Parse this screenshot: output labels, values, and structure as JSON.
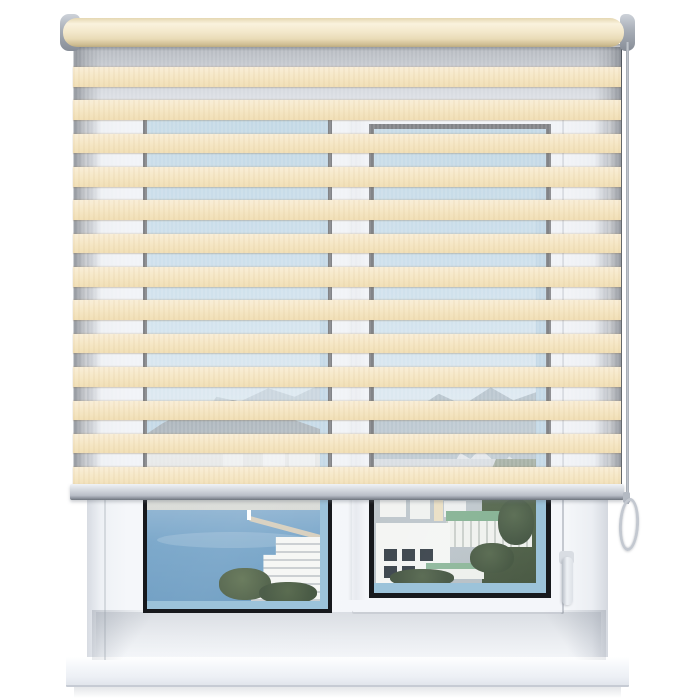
{
  "image": {
    "kind": "product-photo",
    "subject": "cream zebra day-night roller blind lowered over a white PVC window with a seaside town view",
    "width": 700,
    "height": 700
  },
  "palette": {
    "cream": "#f6e8c8",
    "cream-light": "#f9eed8",
    "cream-dark": "#f1dfb6",
    "sheer": "rgba(237,240,244,0.5)",
    "gasket": "#17191d",
    "roller-cream": "#f3e8cb",
    "bar-silver": "#c7ccd4",
    "chain-silver": "#c3c8d0",
    "frame-white": "#f4f6f9",
    "sky-blue": "#a3c9df",
    "sea-blue": "#78a5c9",
    "mountain-gray": "#8ba2b0",
    "tree-green": "#55674d",
    "teal-roof": "#85b293",
    "sill-white": "#f3f6fa"
  },
  "blind": {
    "stripes": {
      "count": 13,
      "first_top": 20,
      "period": 33.35,
      "height": 19.5
    },
    "fabric": {
      "left": 73,
      "top": 47,
      "width": 548,
      "height": 439
    }
  }
}
